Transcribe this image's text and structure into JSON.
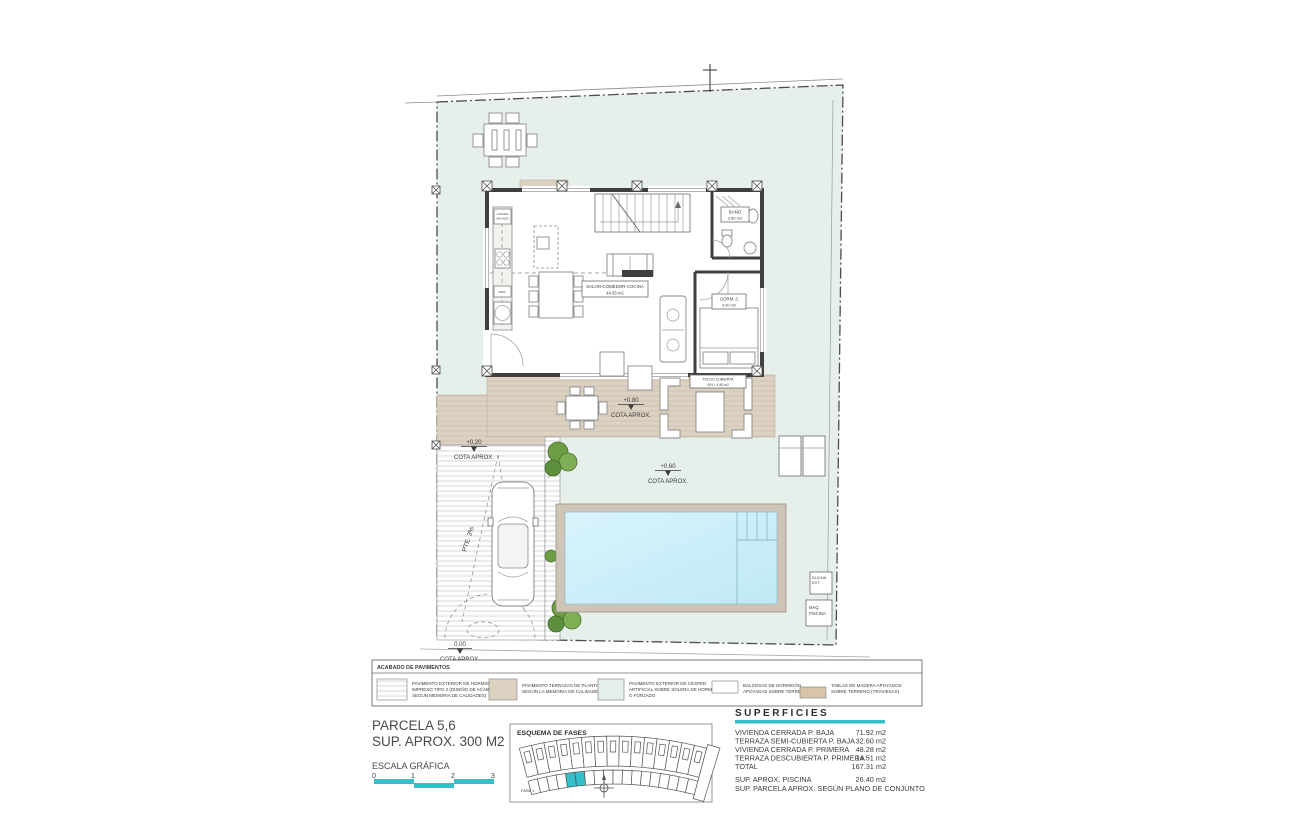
{
  "colors": {
    "accent_cyan": "#35bfca",
    "lawn_green": "#e6efe9",
    "terrace_beige": "#ddd2c2",
    "pool_water": "#c9eef8",
    "pool_border": "#cfc5b6",
    "swatch_tan": "#d8c4a9",
    "wall_grey": "#3f3f3f"
  },
  "plan_labels": {
    "salon_line1": "SALON-COMEDOR-COCINA",
    "salon_line2": "44.93 m2",
    "dorm_line1": "DORM. 3",
    "dorm_line2": "9.90 m2",
    "bano_line1": "BAÑO",
    "bano_line2": "3.80 m2",
    "toldo_line1": "TOLDO CUBIERTA",
    "toldo_line2": "S/N = 4.50 m2",
    "cota_080": "+0.80",
    "cota_020": "+0.20",
    "cota_060": "+0.60",
    "cota_000": "0.00",
    "cota_aprox": "COTA APROX.",
    "pte": "PTE. 3%",
    "ducha_line1": "DUCHA",
    "ducha_line2": "EXT.",
    "maq_line1": "MAQ.",
    "maq_line2": "PISCINA",
    "lavado_line1": "LAVADO",
    "lavado_line2": "SECADO",
    "frig": "FRIG."
  },
  "legend": {
    "title": "ACABADO DE PAVIMENTOS",
    "items": [
      {
        "swatch": "striped-concrete",
        "lines": [
          "PAVIMENTO EXTERIOR DE HORMIGÓN",
          "IMPRESO TIPO 2 (DISEÑO DE ACABADO",
          "SEGÚN MEMORIA DE CALIDADES)"
        ]
      },
      {
        "swatch": "beige-terrace",
        "lines": [
          "PAVIMENTO TERRAZAS DE PLANTA BAJA",
          "SEGÚN LA MEMORIA DE CALIDADES",
          ""
        ]
      },
      {
        "swatch": "artificial-grass",
        "lines": [
          "PAVIMENTO EXTERIOR DE CÉSPED",
          "ARTIFICIAL SOBRE SOLERA DE HORMIGÓN",
          "O FORJADO"
        ]
      },
      {
        "swatch": "white-slab",
        "lines": [
          "BALDOSAS DE HORMIGÓN",
          "APOYADAS SOBRE TERRENO",
          ""
        ]
      },
      {
        "swatch": "wood-sleeper",
        "lines": [
          "TABLAS DE MADERA APOYADOS",
          "SOBRE TERRENO (TRAVIESAS)",
          ""
        ]
      }
    ]
  },
  "title_block": {
    "parcel_title": "PARCELA 5,6",
    "parcel_area": "SUP. APROX. 300 M2",
    "scale_label": "ESCALA GRÁFICA",
    "scale_ticks": [
      "0",
      "1",
      "2",
      "3"
    ]
  },
  "esquema": {
    "title": "ESQUEMA DE FASES",
    "fase_label": "FASE 1"
  },
  "superficies": {
    "title": "SUPERFICIES",
    "rows": [
      {
        "label": "VIVIENDA CERRADA P. BAJA",
        "value": "71.92 m2"
      },
      {
        "label": "TERRAZA SEMI-CUBIERTA P. BAJA",
        "value": "32.60 m2"
      },
      {
        "label": "VIVIENDA CERRADA P. PRIMERA",
        "value": "48.28 m2"
      },
      {
        "label": "TERRAZA DESCUBIERTA P. PRIMERA",
        "value": "14.51 m2"
      },
      {
        "label": "TOTAL",
        "value": "167.31 m2"
      }
    ],
    "piscina_label": "SUP. APROX. PISCINA",
    "piscina_value": "26.40 m2",
    "footnote": "SUP. PARCELA APROX. SEGÚN PLANO DE CONJUNTO"
  }
}
